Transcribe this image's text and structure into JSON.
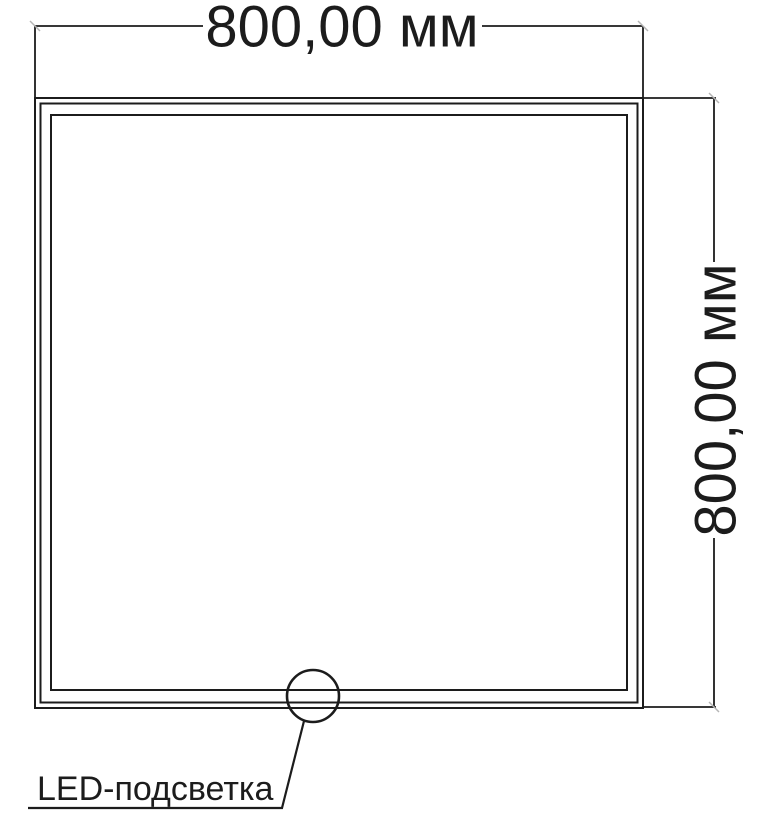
{
  "diagram": {
    "top_dimension": {
      "label": "800,00 мм"
    },
    "right_dimension": {
      "label": "800,00 мм"
    },
    "callout": {
      "label": "LED-подсветка"
    },
    "colors": {
      "line": "#1c1c1c",
      "background": "#ffffff",
      "tick": "#b5b5b5"
    }
  }
}
